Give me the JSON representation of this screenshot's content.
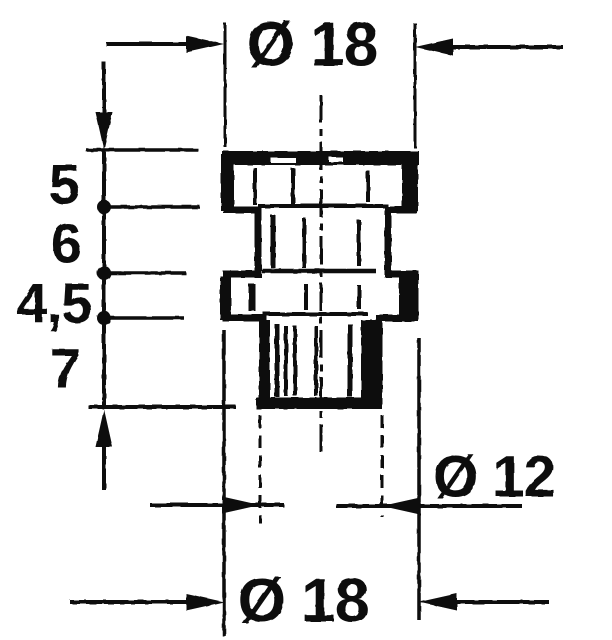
{
  "drawing": {
    "labels": {
      "dia_top": "Ø 18",
      "dia_shank": "Ø 12",
      "dia_bottom": "Ø 18",
      "h_flange": "5",
      "h_neck": "6",
      "h_collar": "4,5",
      "h_shank": "7"
    },
    "dimensions": {
      "top_diameter": {
        "symbol": "Ø",
        "value": 18
      },
      "shank_diameter": {
        "symbol": "Ø",
        "value": 12
      },
      "bottom_diameter": {
        "symbol": "Ø",
        "value": 18
      },
      "segment_heights_top_to_bottom": [
        5,
        6,
        4.5,
        7
      ]
    },
    "style": {
      "ink_color": "#0a0a0a",
      "paper_color": "#ffffff"
    }
  }
}
